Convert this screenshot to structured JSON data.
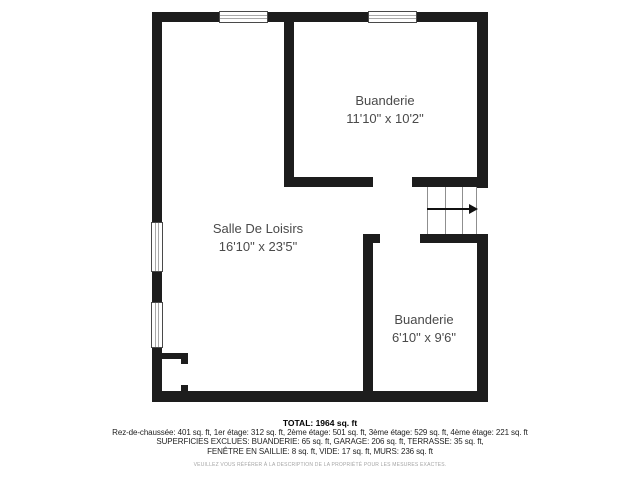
{
  "floorplan": {
    "rooms": [
      {
        "name": "Buanderie",
        "dimensions": "11'10\" x 10'2\""
      },
      {
        "name": "Salle De Loisirs",
        "dimensions": "16'10\" x 23'5\""
      },
      {
        "name": "Buanderie",
        "dimensions": "6'10\" x 9'6\""
      }
    ],
    "stairs": {
      "direction": "right"
    },
    "colors": {
      "wall": "#1d1d1d",
      "room_label": "#4a4a4a",
      "background": "#ffffff"
    }
  },
  "footer": {
    "total": "TOTAL: 1964 sq. ft",
    "areas_line": "Rez-de-chaussée: 401 sq. ft, 1er étage: 312 sq. ft, 2ème étage: 501 sq. ft, 3ème étage: 529 sq. ft, 4ème étage: 221 sq. ft",
    "excluded_line1": "SUPERFICIES EXCLUES: BUANDERIE: 65 sq. ft, GARAGE: 206 sq. ft, TERRASSE: 35 sq. ft,",
    "excluded_line2": "FENÊTRE EN SAILLIE: 8 sq. ft, VIDE: 17 sq. ft, MURS: 236 sq. ft",
    "disclaimer": "VEUILLEZ VOUS RÉFÉRER À LA DESCRIPTION DE LA PROPRIÉTÉ POUR LES MESURES EXACTES."
  }
}
